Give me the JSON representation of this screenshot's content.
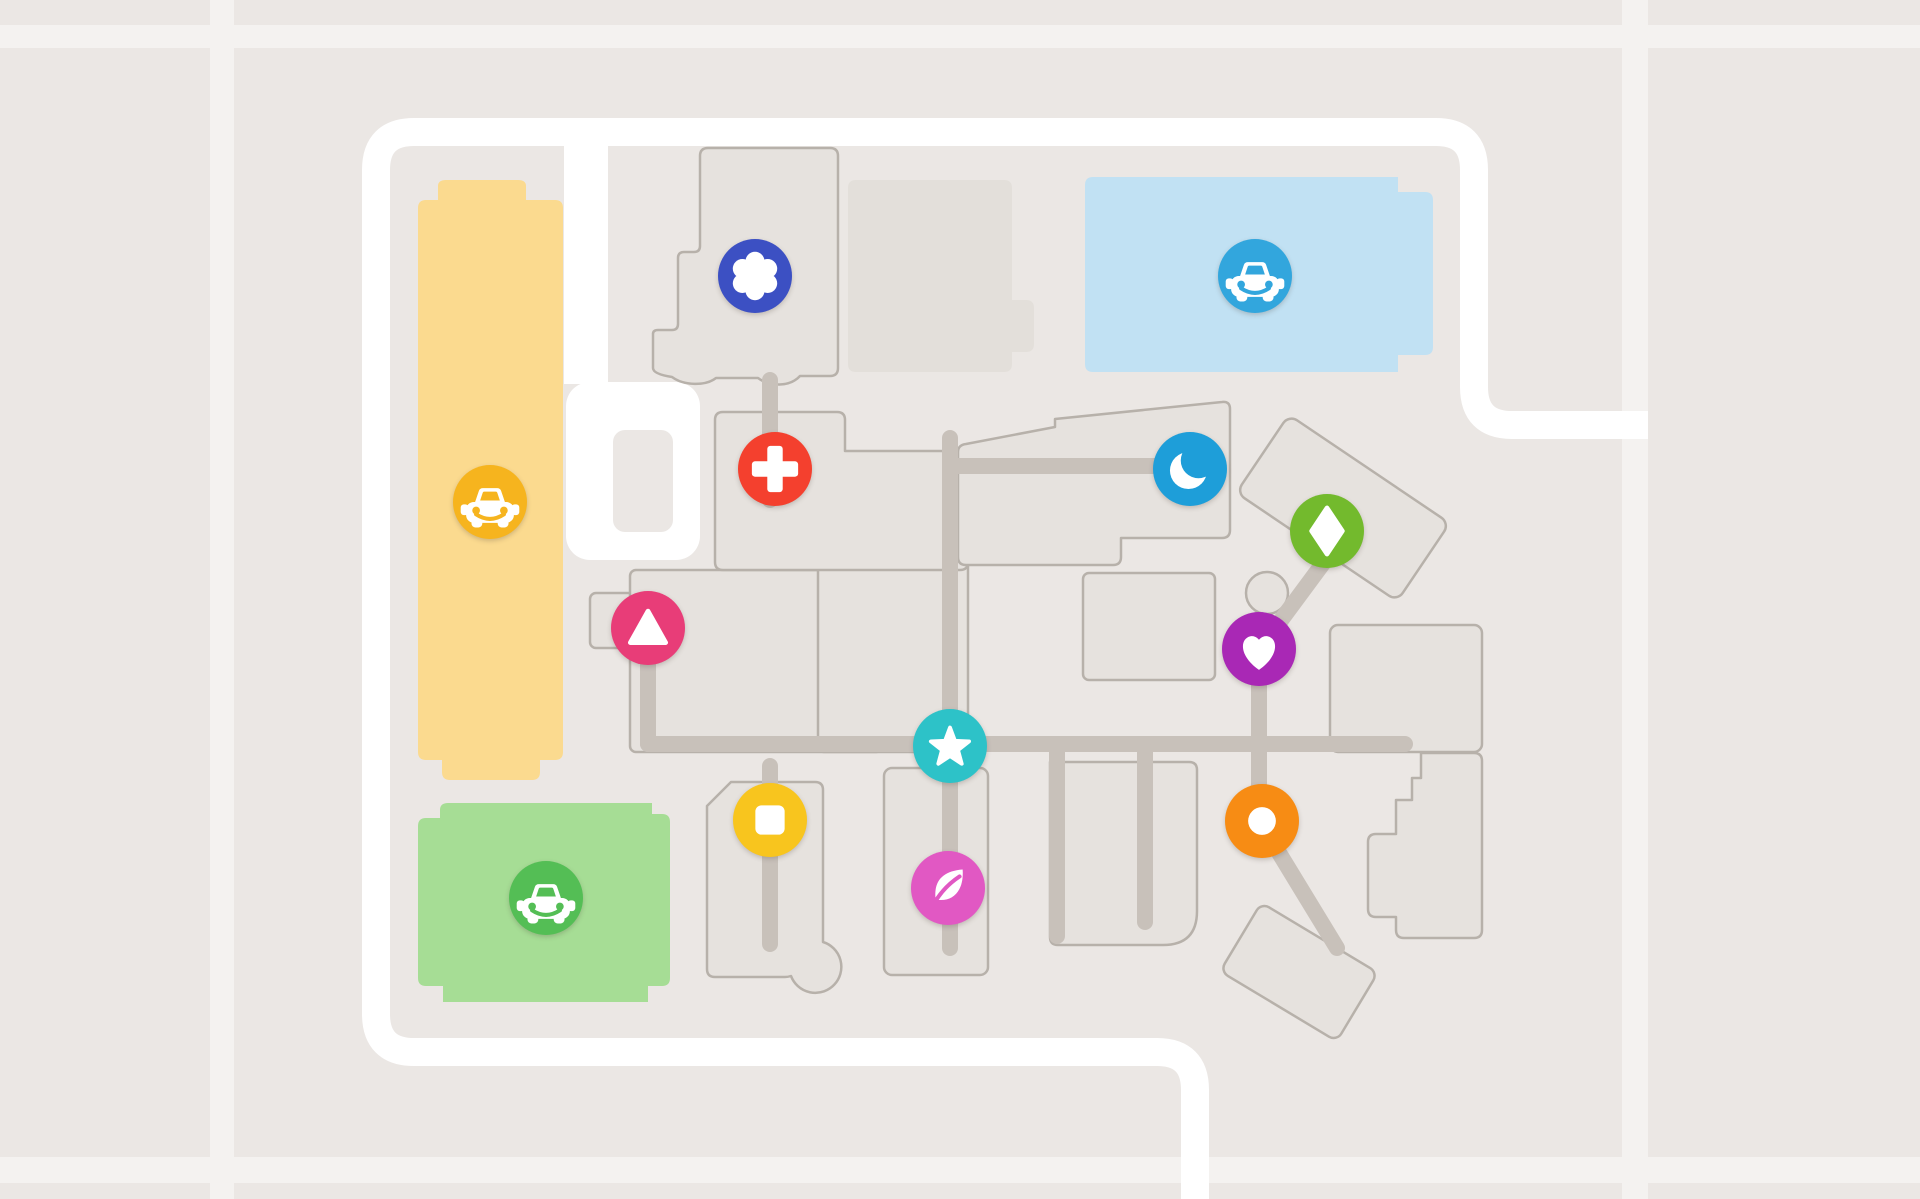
{
  "app": {
    "title": "Venue map view"
  },
  "map": {
    "canvas": {
      "width": 1920,
      "height": 1199
    },
    "colors": {
      "background": "#EBE7E4",
      "faint_road": "#F4F2F0",
      "road": "#FFFFFF",
      "building_fill": "#E6E2DE",
      "building_stroke": "#B7B1AA",
      "plain_building_fill": "#E3DFDA",
      "walkway": "#C8C1BA",
      "marker_glyph": "#FFFFFF"
    },
    "faint_roads": [
      {
        "name": "faint-road-vertical-left",
        "x": 210,
        "y": 0,
        "w": 24,
        "h": 1199
      },
      {
        "name": "faint-road-horizontal-top",
        "x": 0,
        "y": 25,
        "w": 1920,
        "h": 23
      },
      {
        "name": "faint-road-vertical-right",
        "x": 1622,
        "y": 0,
        "w": 26,
        "h": 1199
      },
      {
        "name": "faint-road-horizontal-bottom",
        "x": 0,
        "y": 1157,
        "w": 1920,
        "h": 26
      }
    ],
    "roads": {
      "ring_road": {
        "d": "M1648 425 H1512 Q1474 425 1474 387 V170 Q1474 132 1436 132 H414 Q376 132 376 170 V1014 Q376 1052 414 1052 H1157 Q1195 1052 1195 1090 V1199",
        "width": 28
      },
      "branch_road": {
        "d": "M586 132 V384",
        "width": 44
      },
      "cul_de_sac": {
        "x": 566,
        "y": 382,
        "w": 134,
        "h": 178,
        "rx": 24
      },
      "cul_de_sac_island": {
        "x": 613,
        "y": 430,
        "w": 60,
        "h": 102,
        "rx": 12
      }
    },
    "parking_lots": [
      {
        "name": "parking-lot-yellow",
        "fill": "#FBDA8F",
        "d": "M418 752 V208 Q418 200 426 200 H438 V186 Q438 180 446 180 H518 Q526 180 526 186 V200 H555 Q563 200 563 208 V752 Q563 760 555 760 H540 V772 Q540 780 532 780 H450 Q442 780 442 772 V760 H426 Q418 760 418 752 Z"
      },
      {
        "name": "parking-lot-green",
        "fill": "#A6DD95",
        "d": "M448 803 H652 V814 H662 Q670 814 670 822 V978 Q670 986 662 986 H648 V1002 H443 V986 H426 Q418 986 418 978 V826 Q418 818 426 818 H440 V810 Q440 803 448 803 Z"
      },
      {
        "name": "parking-lot-blue",
        "fill": "#C1E1F3",
        "d": "M1093 177 H1398 V192 H1425 Q1433 192 1433 200 V347 Q1433 355 1425 355 H1398 V372 H1093 Q1085 372 1085 364 V185 Q1085 177 1093 177 Z"
      }
    ],
    "buildings": [
      {
        "name": "building-plain-top-center",
        "kind": "plain",
        "d": "M856 180 H1004 Q1012 180 1012 188 V300 H1026 Q1034 300 1034 308 V344 Q1034 352 1026 352 H1012 V364 Q1012 372 1004 372 H856 Q848 372 848 364 V188 Q848 180 856 180 Z"
      },
      {
        "name": "building-flower",
        "kind": "outlined",
        "d": "M708 148 H830 Q838 148 838 156 V368 Q838 376 830 376 H800 C790 387 770 387 758 378 H716 C706 386 684 386 672 377 Q653 374 653 368 V334 Q653 330 658 330 H672 Q678 330 678 324 V258 Q678 252 684 252 H694 Q700 252 700 246 V156 Q700 148 708 148 Z"
      },
      {
        "name": "building-annex-west",
        "kind": "outlined",
        "rect": {
          "x": 590,
          "y": 593,
          "w": 46,
          "h": 55,
          "rx": 6
        }
      },
      {
        "name": "building-mall-west",
        "kind": "outlined",
        "rect": {
          "x": 630,
          "y": 570,
          "w": 252,
          "h": 182,
          "rx": 6
        }
      },
      {
        "name": "building-mall-center",
        "kind": "outlined",
        "rect": {
          "x": 818,
          "y": 556,
          "w": 150,
          "h": 196,
          "rx": 6
        }
      },
      {
        "name": "building-mall-north",
        "kind": "outlined",
        "d": "M723 412 H837 Q845 412 845 420 V451 H960 Q968 451 968 459 V562 Q968 570 960 570 H723 Q715 570 715 562 V420 Q715 412 723 412 Z"
      },
      {
        "name": "building-mall-northeast",
        "kind": "outlined",
        "d": "M966 444 L1055 427 V419 L1222 402 Q1230 401 1230 409 V530 Q1230 538 1222 538 H1121 V557 Q1121 565 1113 565 H966 Q958 565 958 557 V452 Q958 445 966 444 Z"
      },
      {
        "name": "building-mall-east-upper",
        "kind": "outlined",
        "rect": {
          "x": 1083,
          "y": 573,
          "w": 132,
          "h": 107,
          "rx": 6
        }
      },
      {
        "name": "building-kiosk-round",
        "kind": "outlined",
        "circle": {
          "cx": 1267,
          "cy": 593,
          "r": 21
        }
      },
      {
        "name": "building-mall-east",
        "kind": "outlined",
        "rect": {
          "x": 1330,
          "y": 625,
          "w": 152,
          "h": 127,
          "rx": 8
        }
      },
      {
        "name": "building-mall-southeast",
        "kind": "outlined",
        "d": "M1421 753 L1474 753 Q1482 753 1482 761 L1482 930 Q1482 938 1474 938 L1404 938 Q1396 938 1396 930 L1396 917 L1376 917 Q1368 917 1368 909 L1368 842 Q1368 834 1376 834 L1396 834 L1396 800 L1412 800 L1412 778 L1421 778 Z"
      },
      {
        "name": "building-strip-square",
        "kind": "outlined",
        "d": "M731 782 H815 Q823 782 823 790 V942 A26 26 0 1 1 791 976 Q788 977 785 977 H715 Q707 977 707 969 V806 Z"
      },
      {
        "name": "building-strip-leaf",
        "kind": "outlined",
        "rect": {
          "x": 884,
          "y": 768,
          "w": 104,
          "h": 207,
          "rx": 8
        }
      },
      {
        "name": "building-strip-wide",
        "kind": "outlined",
        "d": "M1050 762 H1189 Q1197 762 1197 770 V911 Q1197 945 1163 945 H1058 Q1050 945 1050 937 Z"
      },
      {
        "name": "building-rotated-northeast",
        "kind": "outlined",
        "rect": {
          "x": -97,
          "y": -47,
          "w": 194,
          "h": 94,
          "rx": 10
        },
        "transform": "translate(1343 508) rotate(34)"
      },
      {
        "name": "building-rotated-southeast",
        "kind": "outlined",
        "rect": {
          "x": -68,
          "y": -40,
          "w": 136,
          "h": 80,
          "rx": 9
        },
        "transform": "translate(1299 972) rotate(31)"
      }
    ],
    "walkways": [
      {
        "name": "walkway-triangle-stub",
        "d": "M648 652 V744"
      },
      {
        "name": "walkway-main-horizontal",
        "d": "M648 744 H1405"
      },
      {
        "name": "walkway-star-vertical",
        "d": "M950 438 V948"
      },
      {
        "name": "walkway-moon-horizontal",
        "d": "M950 466 H1160"
      },
      {
        "name": "walkway-cross-stub",
        "d": "M770 380 V500"
      },
      {
        "name": "walkway-square-vertical",
        "d": "M770 766 V944"
      },
      {
        "name": "walkway-stub-a",
        "d": "M1057 750 V936"
      },
      {
        "name": "walkway-stub-b",
        "d": "M1145 750 V922"
      },
      {
        "name": "walkway-diamond-heart-orange",
        "d": "M1330 554 L1259 650 L1259 820 L1337 948"
      }
    ],
    "markers": [
      {
        "name": "poi-flower",
        "icon": "flower-icon",
        "color": "#3C50C3",
        "x": 755,
        "y": 276
      },
      {
        "name": "parking-badge-blue",
        "icon": "car-icon",
        "color": "#32A6DD",
        "x": 1255,
        "y": 276
      },
      {
        "name": "parking-badge-yellow",
        "icon": "car-icon",
        "color": "#F6B41E",
        "x": 490,
        "y": 502
      },
      {
        "name": "parking-badge-green",
        "icon": "car-icon",
        "color": "#54BE55",
        "x": 546,
        "y": 898
      },
      {
        "name": "poi-medical-cross",
        "icon": "cross-icon",
        "color": "#F4402E",
        "x": 775,
        "y": 469
      },
      {
        "name": "poi-moon",
        "icon": "moon-icon",
        "color": "#1E9ED9",
        "x": 1190,
        "y": 469
      },
      {
        "name": "poi-diamond",
        "icon": "diamond-icon",
        "color": "#73BA2D",
        "x": 1327,
        "y": 531
      },
      {
        "name": "poi-triangle",
        "icon": "triangle-icon",
        "color": "#E83D78",
        "x": 648,
        "y": 628
      },
      {
        "name": "poi-heart",
        "icon": "heart-icon",
        "color": "#A928B5",
        "x": 1259,
        "y": 649
      },
      {
        "name": "poi-star",
        "icon": "star-icon",
        "color": "#2DC2C8",
        "x": 950,
        "y": 746
      },
      {
        "name": "poi-square",
        "icon": "square-icon",
        "color": "#F8C51E",
        "x": 770,
        "y": 820
      },
      {
        "name": "poi-leaf",
        "icon": "leaf-icon",
        "color": "#E158C3",
        "x": 948,
        "y": 888
      },
      {
        "name": "poi-dot",
        "icon": "dot-icon",
        "color": "#F78C14",
        "x": 1262,
        "y": 821
      }
    ]
  }
}
